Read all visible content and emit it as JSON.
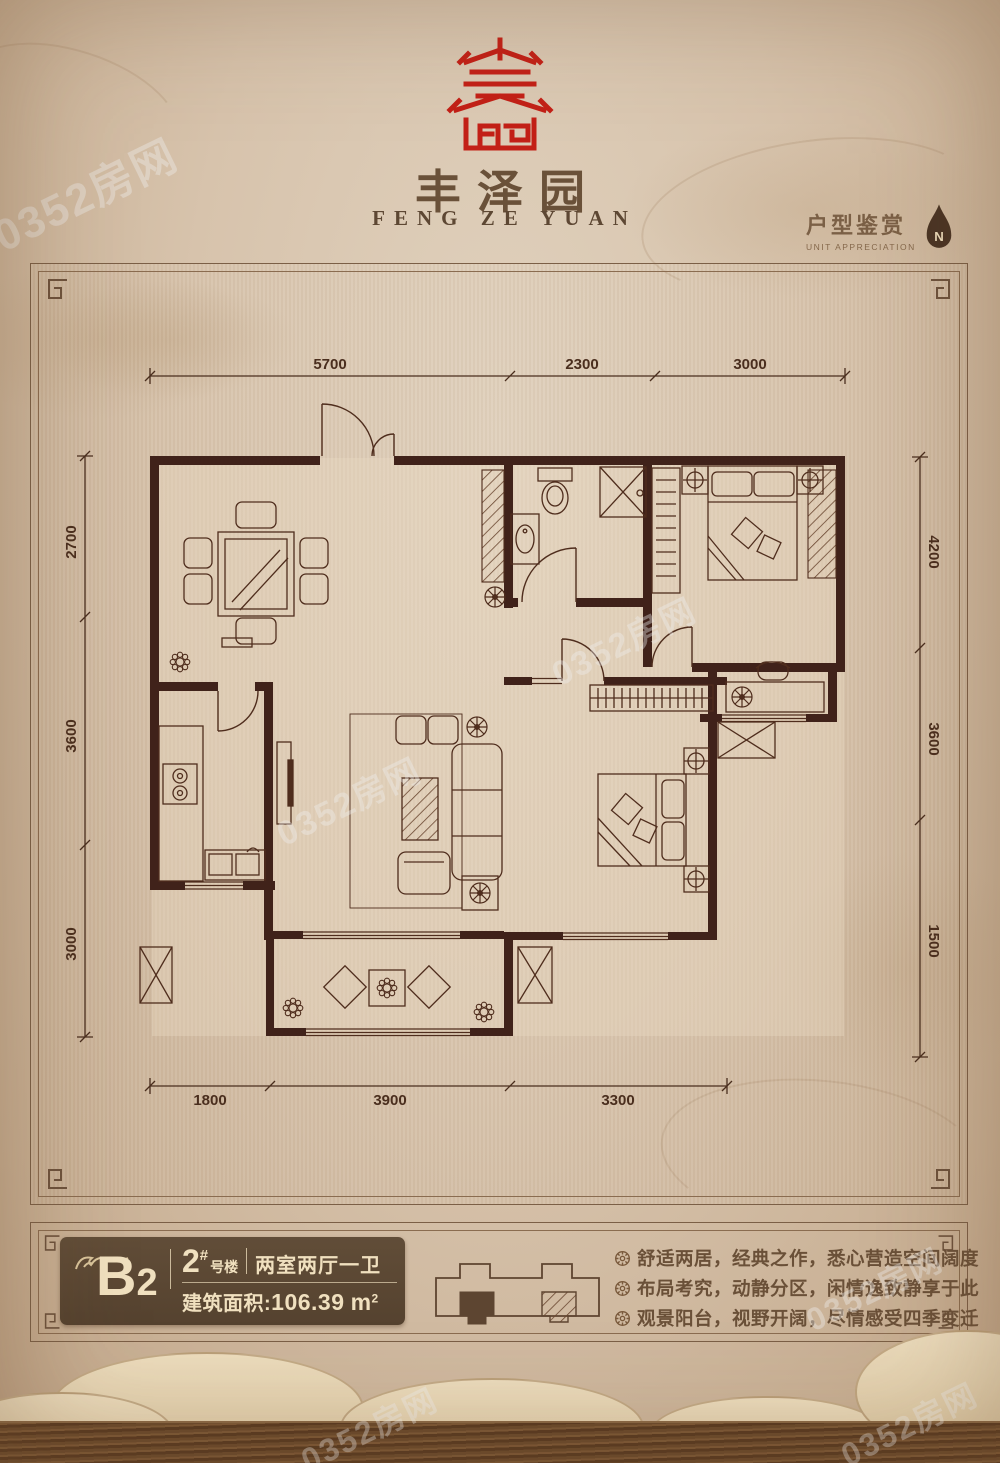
{
  "brand": {
    "title": "丰泽园",
    "subtitle": "FENG ZE YUAN",
    "logo": "red-seal-emblem"
  },
  "gallery": {
    "title": "户型鉴赏",
    "subtitle": "UNIT APPRECIATION",
    "compass_label": "N"
  },
  "plan": {
    "dim_top": [
      "5700",
      "2300",
      "3000"
    ],
    "dim_left": [
      "2700",
      "3600",
      "3000"
    ],
    "dim_right": [
      "4200",
      "3600",
      "1500"
    ],
    "dim_bottom": [
      "1800",
      "3900",
      "3300"
    ]
  },
  "unit": {
    "code_main": "B",
    "code_sub": "2",
    "building_number": "2",
    "building_sup": "#",
    "building_suffix": "号楼",
    "layout": "两室两厅一卫",
    "area_label": "建筑面积:",
    "area_number": "106.39",
    "area_unit": "m",
    "area_unit_exp": "2"
  },
  "features": [
    {
      "text": "舒适两居，经典之作，悉心营造空间阔度"
    },
    {
      "text": "布局考究，动静分区，闲情逸致静享于此"
    },
    {
      "text": "观景阳台，视野开阔，尽情感受四季变迁"
    }
  ],
  "watermark": {
    "text": "0352房网"
  },
  "colors": {
    "accent_red": "#c32017",
    "wall_brown": "#40221a",
    "panel_brown": "#5b4733",
    "cream": "#f0e0bf",
    "text_brown": "#6a5038"
  }
}
